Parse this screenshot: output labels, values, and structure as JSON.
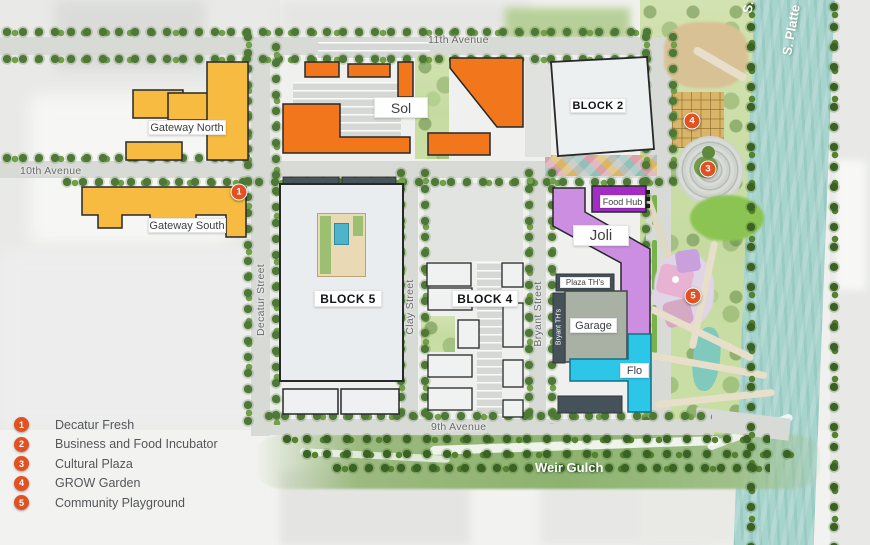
{
  "legend": {
    "items": [
      {
        "number": "1",
        "label": "Decatur Fresh"
      },
      {
        "number": "2",
        "label": "Business and Food Incubator"
      },
      {
        "number": "3",
        "label": "Cultural Plaza"
      },
      {
        "number": "4",
        "label": "GROW Garden"
      },
      {
        "number": "5",
        "label": "Community Playground"
      }
    ]
  },
  "map": {
    "street_labels": {
      "eleventh_avenue": "11th Avenue",
      "tenth_avenue": "10th Avenue",
      "ninth_avenue": "9th Avenue",
      "decatur_street": "Decatur Street",
      "clay_street": "Clay Street",
      "bryant_street": "Bryant Street"
    },
    "water_labels": {
      "s_platte": "S. Platte",
      "s_platte_partial": "S.",
      "weir_gulch": "Weir Gulch"
    },
    "building_labels": {
      "gateway_north": "Gateway North",
      "gateway_south": "Gateway South",
      "sol": "Sol",
      "block_2": "BLOCK 2",
      "block_5": "BLOCK 5",
      "block_4": "BLOCK 4",
      "food_hub": "Food Hub",
      "joli": "Joli",
      "plaza_ths": "Plaza TH's",
      "bryant_ths": "Bryant TH's",
      "garage": "Garage",
      "flo": "Flo"
    },
    "markers": {
      "m1": "1",
      "m3": "3",
      "m4": "4",
      "m5": "5"
    }
  },
  "colors": {
    "marker": "#E25122",
    "gateway_yellow": "#F6BB40",
    "sol_orange": "#F2771C",
    "block_fill": "#EAEDEF",
    "food_hub_purple": "#A32CC4",
    "joli_purple": "#CB8EE0",
    "garage_gray": "#A9B0A4",
    "flo_cyan": "#2CC7E8",
    "river_teal": "#A8D4CE"
  }
}
